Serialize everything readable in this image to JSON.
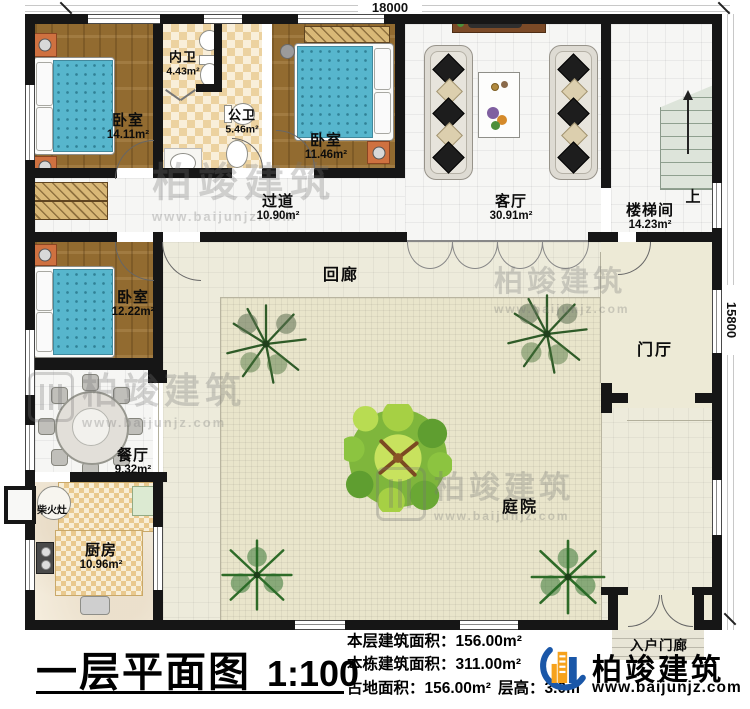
{
  "sheet": {
    "title": "一层平面图",
    "scale": "1:100",
    "dim_width": "18000",
    "dim_height": "15800"
  },
  "rooms": {
    "bedroom1": {
      "name": "卧室",
      "area": "14.11m²"
    },
    "bath_inner": {
      "name": "内卫",
      "area": "4.43m²"
    },
    "bath_public": {
      "name": "公卫",
      "area": "5.46m²"
    },
    "bedroom2": {
      "name": "卧室",
      "area": "11.46m²"
    },
    "hallway": {
      "name": "过道",
      "area": "10.90m²"
    },
    "living": {
      "name": "客厅",
      "area": "30.91m²"
    },
    "stairwell": {
      "name": "楼梯间",
      "area": "14.23m²"
    },
    "bedroom3": {
      "name": "卧室",
      "area": "12.22m²"
    },
    "dining": {
      "name": "餐厅",
      "area": "9.32m²"
    },
    "kitchen": {
      "name": "厨房",
      "area": "10.96m²"
    },
    "cloister": {
      "name": "回廊"
    },
    "courtyard": {
      "name": "庭院"
    },
    "foyer": {
      "name": "门厅"
    },
    "entry_porch": {
      "name": "入户门廊"
    }
  },
  "annotations": {
    "wood_stove": "柴火灶",
    "stairs_up": "上"
  },
  "stats": {
    "floor_area": {
      "label": "本层建筑面积：",
      "value": "156.00m²"
    },
    "total_area": {
      "label": "本栋建筑面积：",
      "value": "311.00m²"
    },
    "land_area": {
      "label": "占地面积：",
      "value": "156.00m²"
    },
    "story_height": {
      "label": "层高：",
      "value": "3.0m"
    }
  },
  "brand": {
    "name": "柏竣建筑",
    "url": "www.baijunjz.com"
  }
}
